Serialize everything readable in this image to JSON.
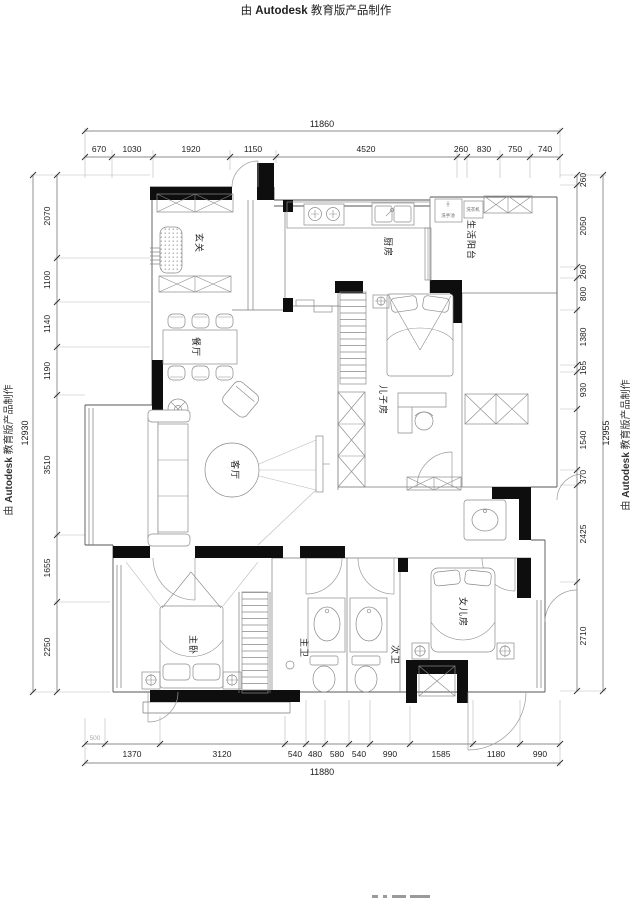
{
  "watermark": {
    "prefix": "由 ",
    "brand": "Autodesk",
    "suffix": " 教育版产品制作"
  },
  "dims": {
    "top": {
      "total": "11860",
      "segments": [
        "670",
        "1030",
        "1920",
        "1150",
        "4520",
        "260",
        "830",
        "750",
        "740"
      ]
    },
    "bottom": {
      "total": "11880",
      "pre": "500",
      "segments": [
        "1370",
        "3120",
        "540",
        "480",
        "580",
        "540",
        "990",
        "1585",
        "1180",
        "990"
      ]
    },
    "left": {
      "total": "12930",
      "segments": [
        "2070",
        "1100",
        "1140",
        "1190",
        "3510",
        "1655",
        "2250"
      ]
    },
    "right": {
      "total": "12955",
      "segments": [
        "260",
        "2050",
        "260",
        "800",
        "1380",
        "165",
        "930",
        "1540",
        "370",
        "2425",
        "2710"
      ]
    }
  },
  "rooms": {
    "entry": "玄关",
    "kitchen": "厨房",
    "balcony": "生活阳台",
    "dining": "餐厅",
    "son": "儿子房",
    "living": "客厅",
    "master": "主卧",
    "master_bath": "主卫",
    "second_bath": "次卫",
    "daughter": "女儿房"
  },
  "fixtures": {
    "basin": "洗手池",
    "washer": "洗衣机"
  },
  "colors": {
    "wall": "#0e0e0e",
    "line": "#7a7a7a",
    "dim_text": "#1c1c1c"
  }
}
